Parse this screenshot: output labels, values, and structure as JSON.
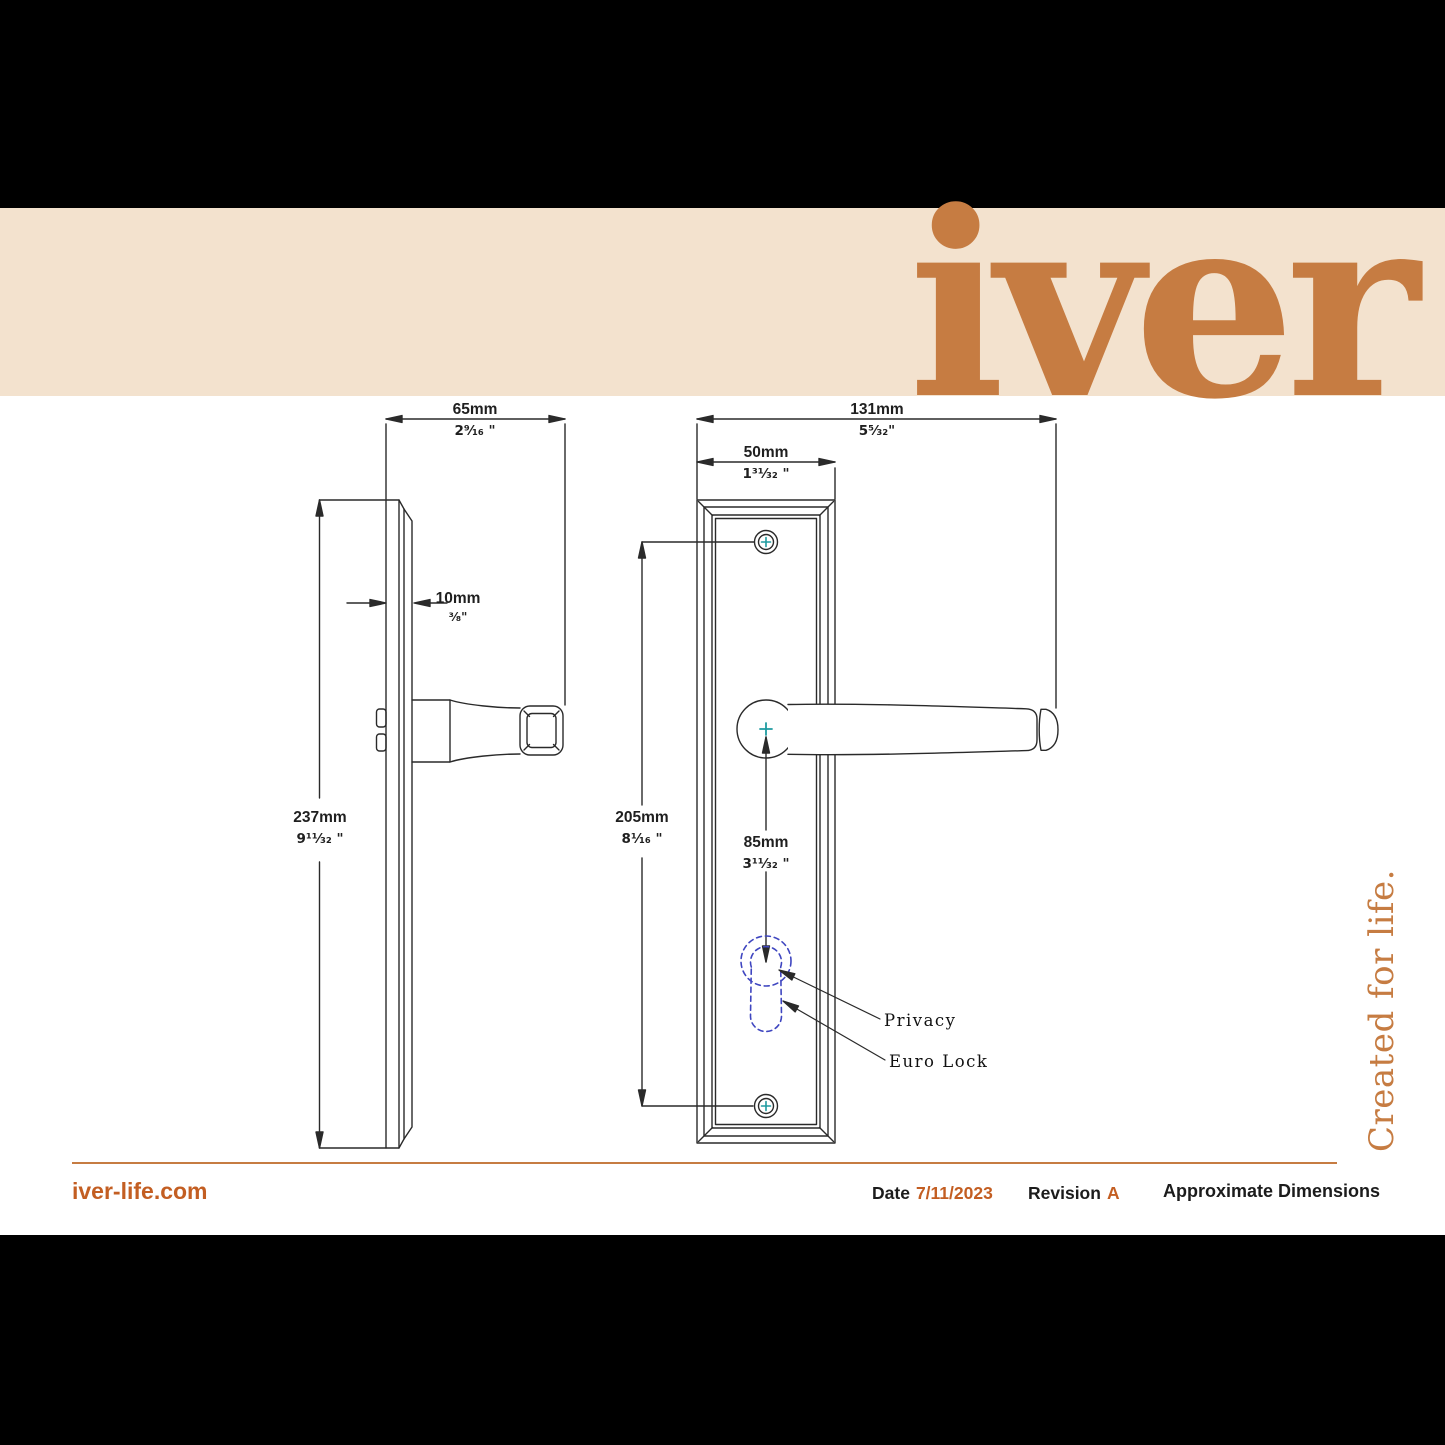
{
  "header": {
    "title": "Door Lever Annecy Stepped",
    "logo": "iver"
  },
  "colors": {
    "accent_orange": "#C35E22",
    "logo_orange": "#C67C42",
    "cream_band": "#F3E2CE",
    "drawing_line": "#2a2a2a",
    "screw_cross_teal": "#1E9BA0",
    "lock_outline_blue": "#3F46C0"
  },
  "dimensions": {
    "projection": {
      "mm": "65mm",
      "inch": "2⁹⁄₁₆ \""
    },
    "thickness": {
      "mm": "10mm",
      "inch": "³⁄₈\""
    },
    "overall_height": {
      "mm": "237mm",
      "inch": "9¹¹⁄₃₂ \""
    },
    "overall_width": {
      "mm": "131mm",
      "inch": "5⁵⁄₃₂\""
    },
    "plate_width": {
      "mm": "50mm",
      "inch": "1³¹⁄₃₂ \""
    },
    "screw_centres": {
      "mm": "205mm",
      "inch": "8¹⁄₁₆ \""
    },
    "centre_to_cylinder": {
      "mm": "85mm",
      "inch": "3¹¹⁄₃₂ \""
    }
  },
  "annotations": {
    "privacy": "Privacy",
    "euro_lock": "Euro Lock"
  },
  "tagline": "Created for life.",
  "footer": {
    "website": "iver-life.com",
    "date_label": "Date",
    "date_value": "7/11/2023",
    "revision_label": "Revision",
    "revision_value": "A",
    "note": "Approximate Dimensions"
  }
}
